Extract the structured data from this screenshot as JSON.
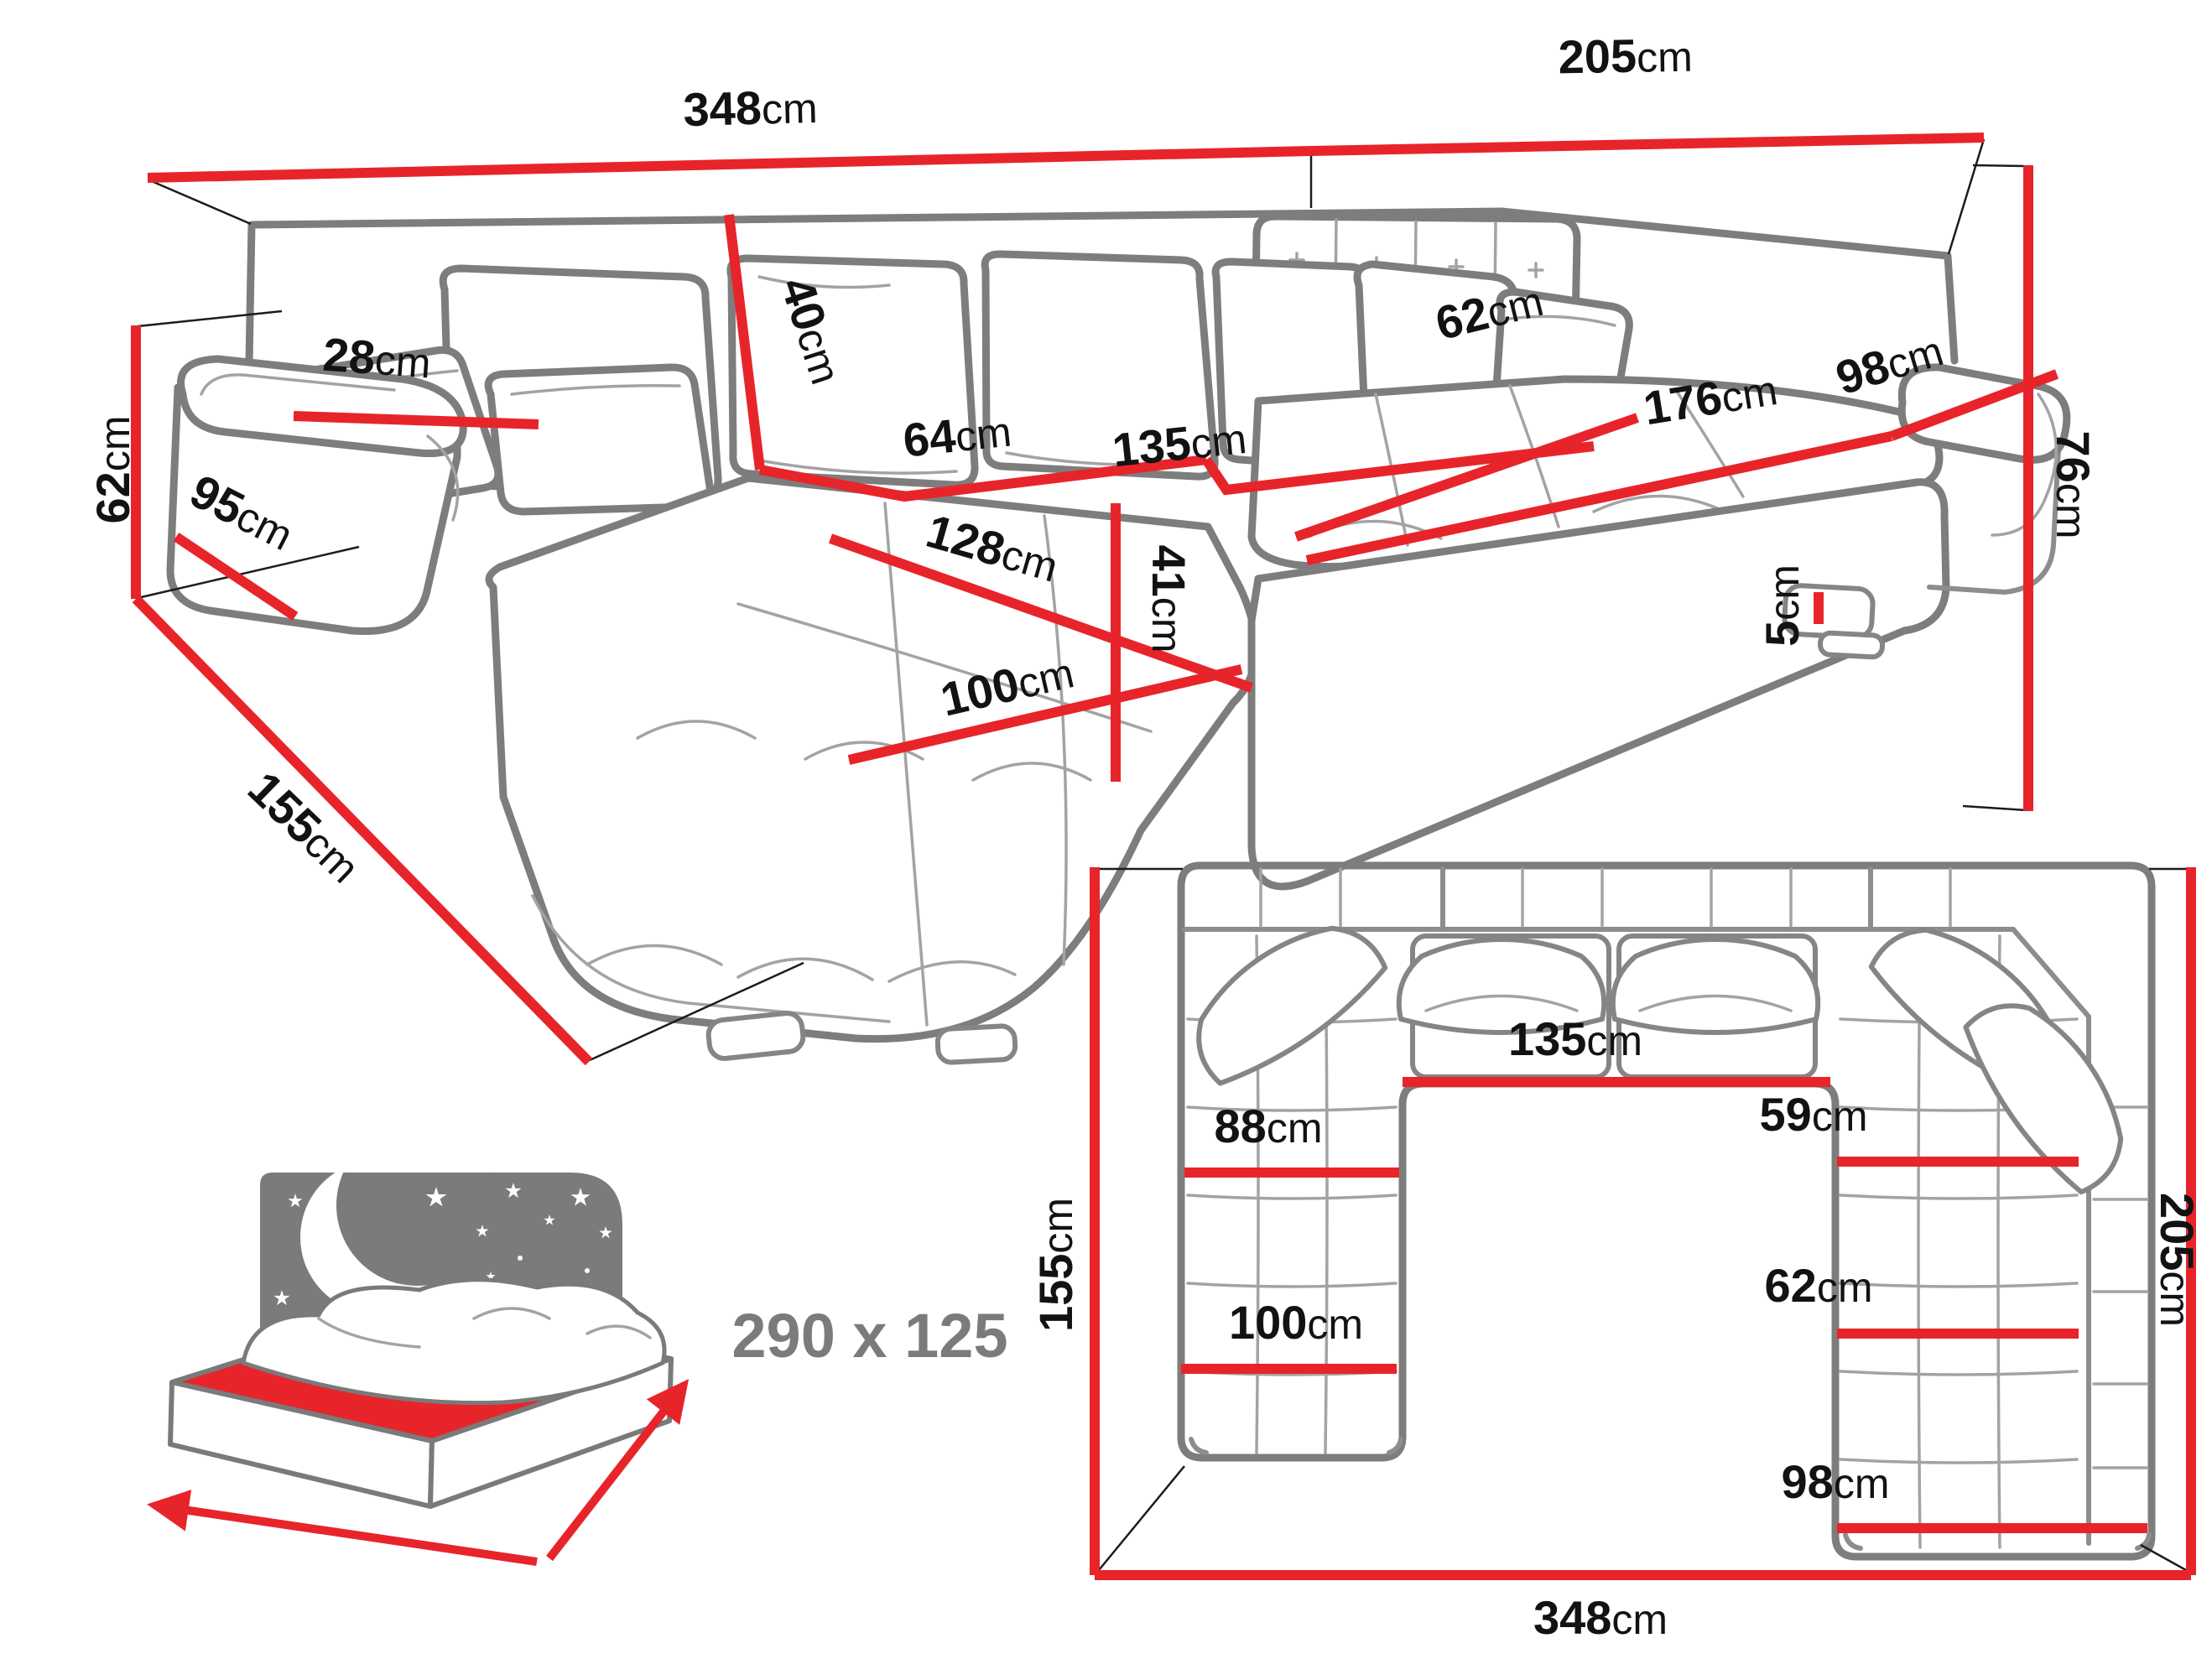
{
  "page": {
    "background": "#ffffff",
    "kind": "corner-sofa dimension diagram"
  },
  "colors": {
    "dimension_red": "#e8242b",
    "outline_gray": "#7d7d7d",
    "crease_gray": "#a3a3a3",
    "label_black": "#121212",
    "bed_gray": "#7b7b7b"
  },
  "perspective_view": {
    "name": "U-shaped corner sofa, perspective view",
    "dims": {
      "back_width": {
        "num": "348",
        "unit": "cm"
      },
      "right_width": {
        "num": "205",
        "unit": "cm"
      },
      "height_right": {
        "num": "76",
        "unit": "cm"
      },
      "height_left": {
        "num": "62",
        "unit": "cm"
      },
      "depth_left": {
        "num": "155",
        "unit": "cm"
      },
      "arm_front_h": {
        "num": "95",
        "unit": "cm"
      },
      "armrest_top": {
        "num": "28",
        "unit": "cm"
      },
      "backrest_h": {
        "num": "40",
        "unit": "cm"
      },
      "seat_left_w": {
        "num": "64",
        "unit": "cm"
      },
      "seat_mid_w": {
        "num": "135",
        "unit": "cm"
      },
      "chaise_len": {
        "num": "128",
        "unit": "cm"
      },
      "chaise_w": {
        "num": "100",
        "unit": "cm"
      },
      "seat_h": {
        "num": "41",
        "unit": "cm"
      },
      "seat_right_d": {
        "num": "62",
        "unit": "cm"
      },
      "seat_right_w": {
        "num": "176",
        "unit": "cm"
      },
      "right_wing_w": {
        "num": "98",
        "unit": "cm"
      },
      "leg_h": {
        "num": "5",
        "unit": "cm"
      }
    }
  },
  "plan_view": {
    "name": "U-shaped corner sofa, top plan view",
    "dims": {
      "depth_left": {
        "num": "155",
        "unit": "cm"
      },
      "depth_right": {
        "num": "205",
        "unit": "cm"
      },
      "total_width": {
        "num": "348",
        "unit": "cm"
      },
      "mid_seat_w": {
        "num": "135",
        "unit": "cm"
      },
      "chaise_inner_w": {
        "num": "88",
        "unit": "cm"
      },
      "chaise_outer_w": {
        "num": "100",
        "unit": "cm"
      },
      "wing_inner_w": {
        "num": "59",
        "unit": "cm"
      },
      "wing_seat_w": {
        "num": "62",
        "unit": "cm"
      },
      "wing_outer_w": {
        "num": "98",
        "unit": "cm"
      }
    }
  },
  "sleeping_area": {
    "icon": "bed-with-moon-and-stars",
    "label": "290 x 125"
  }
}
